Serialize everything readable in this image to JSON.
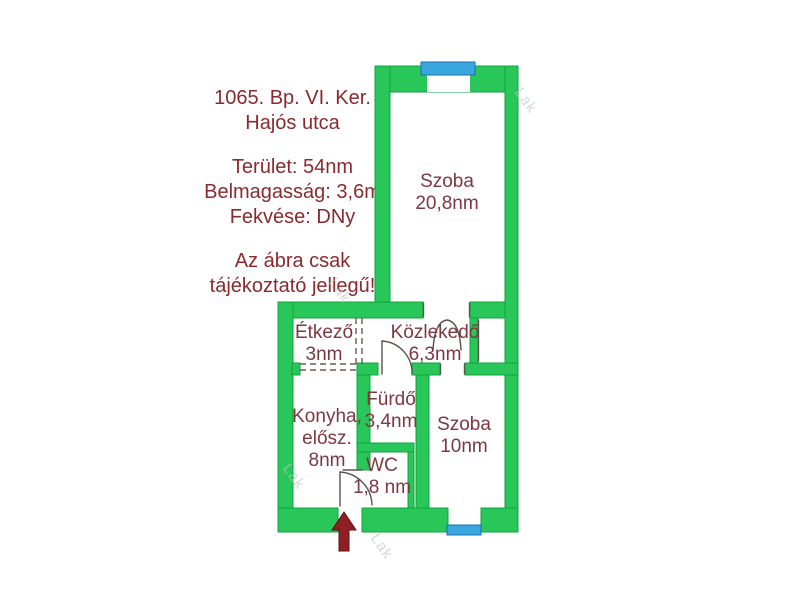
{
  "listing": {
    "address_line1": "1065. Bp. VI. Ker.",
    "address_line2": "Hajós utca",
    "details": [
      "Terület: 54nm",
      "Belmagasság: 3,6m",
      "Fekvése: DNy"
    ],
    "disclaimer_line1": "Az ábra csak",
    "disclaimer_line2": "tájékoztató jellegű!"
  },
  "plan": {
    "rooms": {
      "szoba_nagy": {
        "lines": [
          "Szoba",
          "20,8nm"
        ]
      },
      "etkezo": {
        "lines": [
          "Étkező",
          "3nm"
        ]
      },
      "kozlekedo": {
        "lines": [
          "Közlekedő",
          "6,3nm"
        ]
      },
      "furdo": {
        "lines": [
          "Fürdő",
          "3,4nm"
        ]
      },
      "konyha": {
        "lines": [
          "Konyha,",
          "elősz.",
          "8nm"
        ]
      },
      "wc": {
        "lines": [
          "WC",
          "1,8 nm"
        ]
      },
      "szoba_kis": {
        "lines": [
          "Szoba",
          "10nm"
        ]
      }
    },
    "watermark": "Lak"
  },
  "colors": {
    "wall": "#29c65a",
    "wall_edge": "#0fa43e",
    "window": "#3aa6df",
    "window_edge": "#1c6fa6",
    "label": "#7d3740",
    "info": "#8b2a2e",
    "line": "#5a554a",
    "dash": "#6e5a50",
    "arrow": "#8e1f24",
    "watermark": "#b9c9bb"
  }
}
